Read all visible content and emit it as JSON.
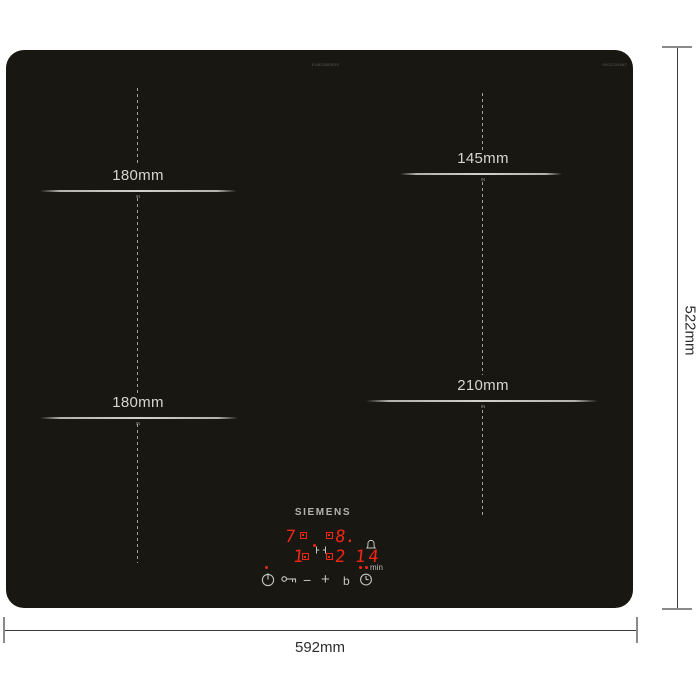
{
  "hob": {
    "brand": "SIEMENS",
    "model_code": "EU631BEB1E",
    "corner_code": "9001234567",
    "body_color": "#191712"
  },
  "zones": [
    {
      "name": "rear-left",
      "label": "180mm",
      "marking": "IN"
    },
    {
      "name": "rear-right",
      "label": "145mm",
      "marking": "IN"
    },
    {
      "name": "front-left",
      "label": "180mm",
      "marking": "IN"
    },
    {
      "name": "front-right",
      "label": "210mm",
      "marking": "IN"
    }
  ],
  "dimensions": {
    "width": "592mm",
    "height": "522mm"
  },
  "display": {
    "rear_left_level": "7",
    "rear_right_level": "8.",
    "front_left_level": "1",
    "front_right_level": "2",
    "timer": "14",
    "timer_unit": "min",
    "digit_color": "#f02715"
  },
  "controls": {
    "minus": "−",
    "plus": "+",
    "boost": "b"
  }
}
